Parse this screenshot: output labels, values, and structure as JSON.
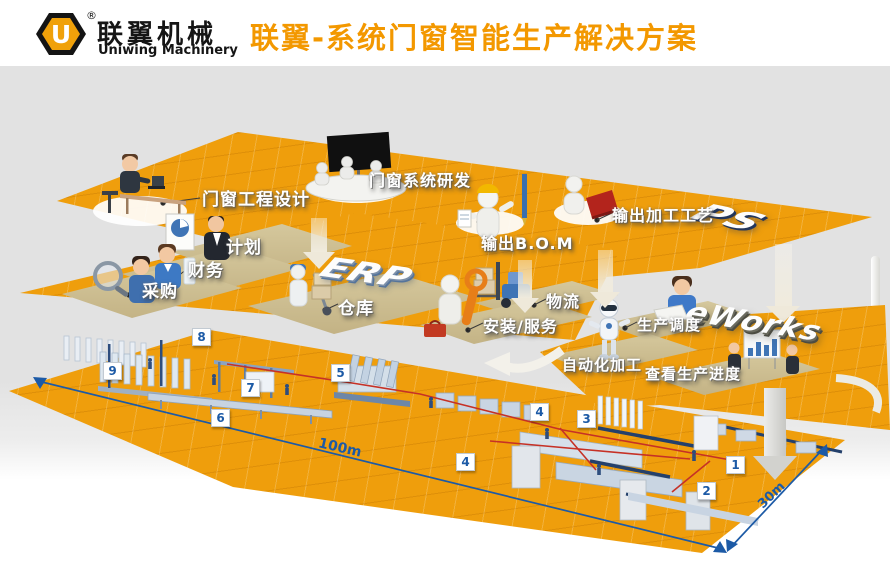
{
  "header": {
    "logo_mark": "U",
    "registered_mark": "®",
    "company_name_cn": "联翼机械",
    "company_name_en": "Uniwing Machinery",
    "title": "联翼-系统门窗智能生产解决方案"
  },
  "platforms": {
    "ps": {
      "logo3d": "PS",
      "stations": {
        "design": "门窗工程设计",
        "research": "门窗系统研发",
        "bom": "输出B.O.M",
        "craft": "输出加工工艺"
      }
    },
    "erp": {
      "logo3d": "ERP",
      "stations": {
        "plan": "计划",
        "finance": "财务",
        "purchase": "采购",
        "warehouse": "仓库",
        "logistics": "物流",
        "service": "安装/服务"
      }
    },
    "eworks": {
      "logo3d": "eWorks",
      "stations": {
        "dispatch": "生产调度",
        "auto": "自动化加工",
        "progress": "查看生产进度"
      }
    }
  },
  "factory": {
    "markers": [
      "1",
      "2",
      "3",
      "4",
      "4",
      "5",
      "6",
      "7",
      "8",
      "9"
    ],
    "dim_length": "100m",
    "dim_width": "30m"
  },
  "colors": {
    "accent_orange": "#f39800",
    "platform_orange": "#ef9e0c",
    "podium_tan": "#cdbd8f",
    "marker_blue": "#1c5aa6",
    "red_path": "#c63126",
    "machine_blue": "#c9d5e3"
  }
}
